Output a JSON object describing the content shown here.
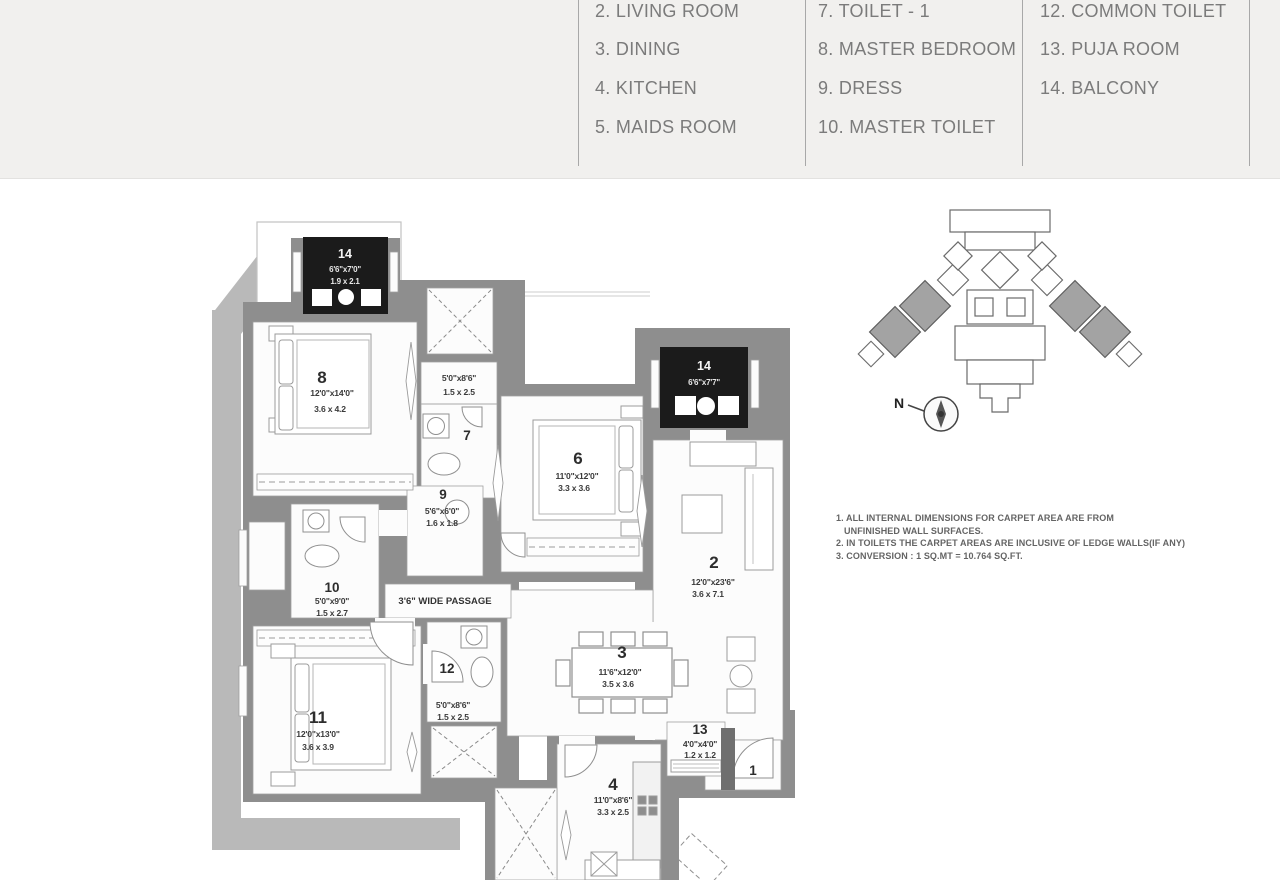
{
  "legend": {
    "columns": [
      {
        "items": [
          "2. LIVING ROOM",
          "3. DINING",
          "4. KITCHEN",
          "5. MAIDS ROOM"
        ]
      },
      {
        "items": [
          "7. TOILET - 1",
          "8. MASTER BEDROOM",
          "9. DRESS",
          "10. MASTER TOILET"
        ]
      },
      {
        "items": [
          "12. COMMON TOILET",
          "13. PUJA ROOM",
          "14. BALCONY"
        ]
      }
    ]
  },
  "plan": {
    "passage_label": "3'6\" WIDE PASSAGE",
    "rooms": {
      "living": {
        "num": "2",
        "ft": "12'0\"x23'6\"",
        "m": "3.6 x 7.1"
      },
      "dining": {
        "num": "3",
        "ft": "11'6\"x12'0\"",
        "m": "3.5 x 3.6"
      },
      "kitchen": {
        "num": "4",
        "ft": "11'0\"x8'6\"",
        "m": "3.3 x 2.5"
      },
      "bed6": {
        "num": "6",
        "ft": "11'0\"x12'0\"",
        "m": "3.3 x 3.6"
      },
      "toilet7": {
        "num": "7",
        "ft": "5'0\"x8'6\"",
        "m": "1.5 x 2.5"
      },
      "master8": {
        "num": "8",
        "ft": "12'0\"x14'0\"",
        "m": "3.6 x 4.2"
      },
      "dress9": {
        "num": "9",
        "ft": "5'6\"x6'0\"",
        "m": "1.6 x 1.8"
      },
      "mtoilet10": {
        "num": "10",
        "ft": "5'0\"x9'0\"",
        "m": "1.5 x 2.7"
      },
      "bed11": {
        "num": "11",
        "ft": "12'0\"x13'0\"",
        "m": "3.6 x 3.9"
      },
      "ctoilet12": {
        "num": "12",
        "ft": "5'0\"x8'6\"",
        "m": "1.5 x 2.5"
      },
      "puja13": {
        "num": "13",
        "ft": "4'0\"x4'0\"",
        "m": "1.2 x 1.2"
      },
      "foyer1": {
        "num": "1"
      },
      "balcony_top": {
        "num": "14",
        "ft": "6'6\"x7'0\"",
        "m": "1.9 x 2.1"
      },
      "balcony_right": {
        "num": "14",
        "ft": "6'6\"x7'7\""
      }
    }
  },
  "north_label": "N",
  "notes": {
    "line1": "1. ALL INTERNAL DIMENSIONS FOR CARPET AREA ARE FROM",
    "line2": "UNFINISHED WALL SURFACES.",
    "line3": "2. IN TOILETS THE CARPET AREAS ARE INCLUSIVE OF LEDGE WALLS(IF ANY)",
    "line4": "3. CONVERSION : 1 SQ.MT = 10.764 SQ.FT."
  },
  "colors": {
    "band": "#f1f0ee",
    "wall": "#8e8e8e",
    "light_band": "#b9b9b9",
    "black_box": "#1b1b1b",
    "legend_text": "#7b7b7b"
  }
}
